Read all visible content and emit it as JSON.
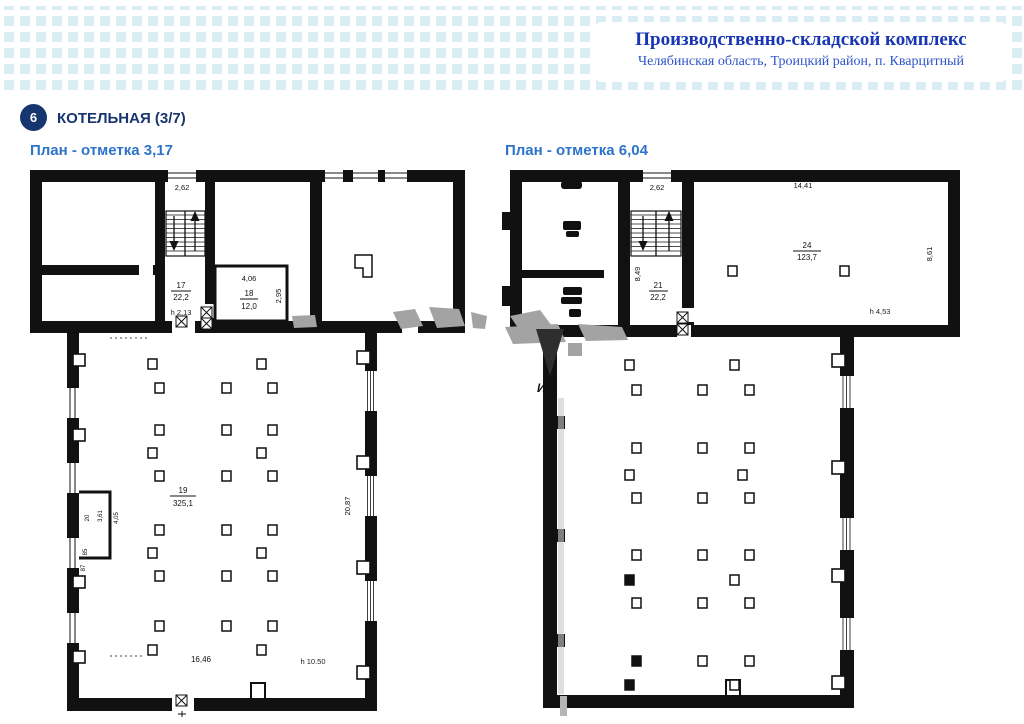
{
  "header": {
    "title": "Производственно-складской комплекс",
    "subtitle": "Челябинская область, Троицкий район, п. Кварцитный"
  },
  "section": {
    "badge": "6",
    "title": "КОТЕЛЬНАЯ (3/7)"
  },
  "watermark": {
    "text": "ИМ"
  },
  "plans": {
    "left": {
      "title": "План - отметка 3,17",
      "labels": {
        "stair_width": "2,62",
        "stair_depth": "8,49",
        "room17_num": "17",
        "room17_area": "22,2",
        "room17_h": "h 2,13",
        "room18_width": "4,06",
        "room18_num": "18",
        "room18_area": "12,0",
        "room18_depth": "2,95",
        "hall_num": "19",
        "hall_area": "325,1",
        "hall_depth": "20,87",
        "hall_width": "16,46",
        "hall_h": "h 10.50",
        "vest_num": "20",
        "vest_dim1": "3,61",
        "vest_dim2": "4,05",
        "mark1": "85",
        "mark2": "87"
      },
      "columns": [
        [
          123,
          193
        ],
        [
          232,
          193
        ],
        [
          130,
          217
        ],
        [
          197,
          217
        ],
        [
          243,
          217
        ],
        [
          130,
          259
        ],
        [
          197,
          259
        ],
        [
          243,
          259
        ],
        [
          123,
          282
        ],
        [
          232,
          282
        ],
        [
          130,
          305
        ],
        [
          197,
          305
        ],
        [
          243,
          305
        ],
        [
          130,
          359
        ],
        [
          197,
          359
        ],
        [
          243,
          359
        ],
        [
          123,
          382
        ],
        [
          232,
          382
        ],
        [
          130,
          405
        ],
        [
          197,
          405
        ],
        [
          243,
          405
        ],
        [
          130,
          455
        ],
        [
          197,
          455
        ],
        [
          243,
          455
        ],
        [
          123,
          479
        ],
        [
          232,
          479
        ]
      ]
    },
    "right": {
      "title": "План - отметка 6,04",
      "labels": {
        "stair_width": "2,62",
        "stair_depth": "8,49",
        "room21_num": "21",
        "room21_area": "22,2",
        "room24_width": "14,41",
        "room24_num": "24",
        "room24_area": "123,7",
        "room24_depth": "8,61",
        "room24_h": "h 4,53"
      },
      "columns": [
        [
          228,
          100
        ],
        [
          340,
          100
        ],
        [
          125,
          194
        ],
        [
          230,
          194
        ],
        [
          132,
          219
        ],
        [
          198,
          219
        ],
        [
          245,
          219
        ],
        [
          132,
          277
        ],
        [
          198,
          277
        ],
        [
          245,
          277
        ],
        [
          125,
          304
        ],
        [
          238,
          304
        ],
        [
          132,
          327
        ],
        [
          198,
          327
        ],
        [
          245,
          327
        ],
        [
          132,
          384
        ],
        [
          198,
          384
        ],
        [
          245,
          384
        ],
        [
          125,
          409,
          1
        ],
        [
          230,
          409
        ],
        [
          132,
          432
        ],
        [
          198,
          432
        ],
        [
          245,
          432
        ],
        [
          132,
          490,
          1
        ],
        [
          198,
          490
        ],
        [
          245,
          490
        ],
        [
          125,
          514,
          1
        ],
        [
          230,
          514
        ]
      ]
    }
  }
}
